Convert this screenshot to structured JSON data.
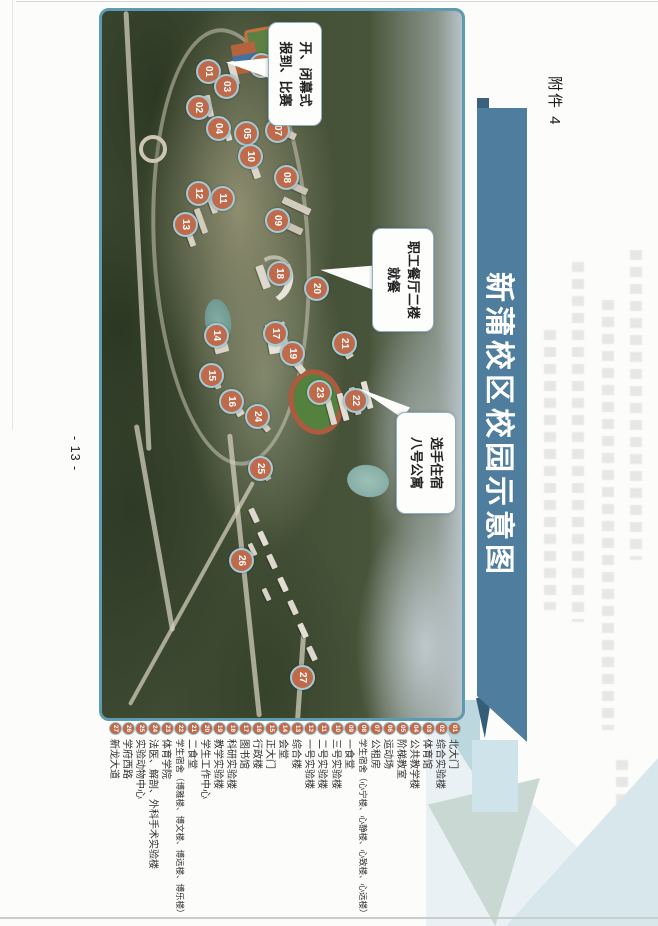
{
  "header": {
    "attachment_label": "附件 4",
    "title": "新蒲校区校园示意图"
  },
  "footer": {
    "page_number": "- 13 -"
  },
  "callouts": {
    "ceremony": {
      "line1": "开、闭幕式",
      "line2": "报到、比赛"
    },
    "dining": {
      "line1": "职工餐厅二楼",
      "line2": "就餐"
    },
    "lodging": {
      "line1": "选手住宿",
      "line2": "八号公寓"
    }
  },
  "map": {
    "markers": [
      {
        "n": "01",
        "x": 71,
        "y": 449
      },
      {
        "n": "02",
        "x": 107,
        "y": 459
      },
      {
        "n": "03",
        "x": 86,
        "y": 431
      },
      {
        "n": "04",
        "x": 128,
        "y": 439
      },
      {
        "n": "05",
        "x": 133,
        "y": 411
      },
      {
        "n": "06",
        "x": 65,
        "y": 396
      },
      {
        "n": "07",
        "x": 130,
        "y": 380
      },
      {
        "n": "08",
        "x": 177,
        "y": 371
      },
      {
        "n": "09",
        "x": 220,
        "y": 380
      },
      {
        "n": "10",
        "x": 156,
        "y": 407
      },
      {
        "n": "11",
        "x": 198,
        "y": 435
      },
      {
        "n": "12",
        "x": 193,
        "y": 459
      },
      {
        "n": "13",
        "x": 224,
        "y": 472
      },
      {
        "n": "14",
        "x": 335,
        "y": 441
      },
      {
        "n": "15",
        "x": 375,
        "y": 446
      },
      {
        "n": "16",
        "x": 401,
        "y": 426
      },
      {
        "n": "17",
        "x": 333,
        "y": 382
      },
      {
        "n": "18",
        "x": 273,
        "y": 378
      },
      {
        "n": "19",
        "x": 353,
        "y": 365
      },
      {
        "n": "20",
        "x": 288,
        "y": 341
      },
      {
        "n": "21",
        "x": 343,
        "y": 313
      },
      {
        "n": "22",
        "x": 400,
        "y": 302
      },
      {
        "n": "23",
        "x": 392,
        "y": 338
      },
      {
        "n": "24",
        "x": 416,
        "y": 400
      },
      {
        "n": "25",
        "x": 468,
        "y": 397
      },
      {
        "n": "26",
        "x": 560,
        "y": 416
      },
      {
        "n": "27",
        "x": 677,
        "y": 355
      }
    ]
  },
  "legend": {
    "items": [
      {
        "n": "01",
        "label": "北大门"
      },
      {
        "n": "02",
        "label": "综合实验楼"
      },
      {
        "n": "03",
        "label": "体育馆"
      },
      {
        "n": "04",
        "label": "公共教学楼"
      },
      {
        "n": "05",
        "label": "阶梯教室"
      },
      {
        "n": "06",
        "label": "运动场"
      },
      {
        "n": "07",
        "label": "公租房"
      },
      {
        "n": "08",
        "label": "学生宿舍（心宁楼、心静楼、心致楼、心远楼）"
      },
      {
        "n": "09",
        "label": "一食堂"
      },
      {
        "n": "10",
        "label": "三号实验楼"
      },
      {
        "n": "11",
        "label": "二号实验楼"
      },
      {
        "n": "12",
        "label": "一号实验楼"
      },
      {
        "n": "13",
        "label": "综合楼"
      },
      {
        "n": "14",
        "label": "会堂"
      },
      {
        "n": "15",
        "label": "正大门"
      },
      {
        "n": "16",
        "label": "行政楼"
      },
      {
        "n": "17",
        "label": "图书馆"
      },
      {
        "n": "18",
        "label": "科研实验楼"
      },
      {
        "n": "19",
        "label": "教学实验楼"
      },
      {
        "n": "20",
        "label": "学生工作中心"
      },
      {
        "n": "21",
        "label": "二食堂"
      },
      {
        "n": "22",
        "label": "学生宿舍（博雅楼、博文楼、博远楼、博乐楼）"
      },
      {
        "n": "23",
        "label": "体育学院"
      },
      {
        "n": "24",
        "label": "法医、解剖、外科手术实验楼"
      },
      {
        "n": "25",
        "label": "实验动物中心"
      },
      {
        "n": "26",
        "label": "学府西路"
      },
      {
        "n": "27",
        "label": "新龙大道"
      }
    ]
  }
}
